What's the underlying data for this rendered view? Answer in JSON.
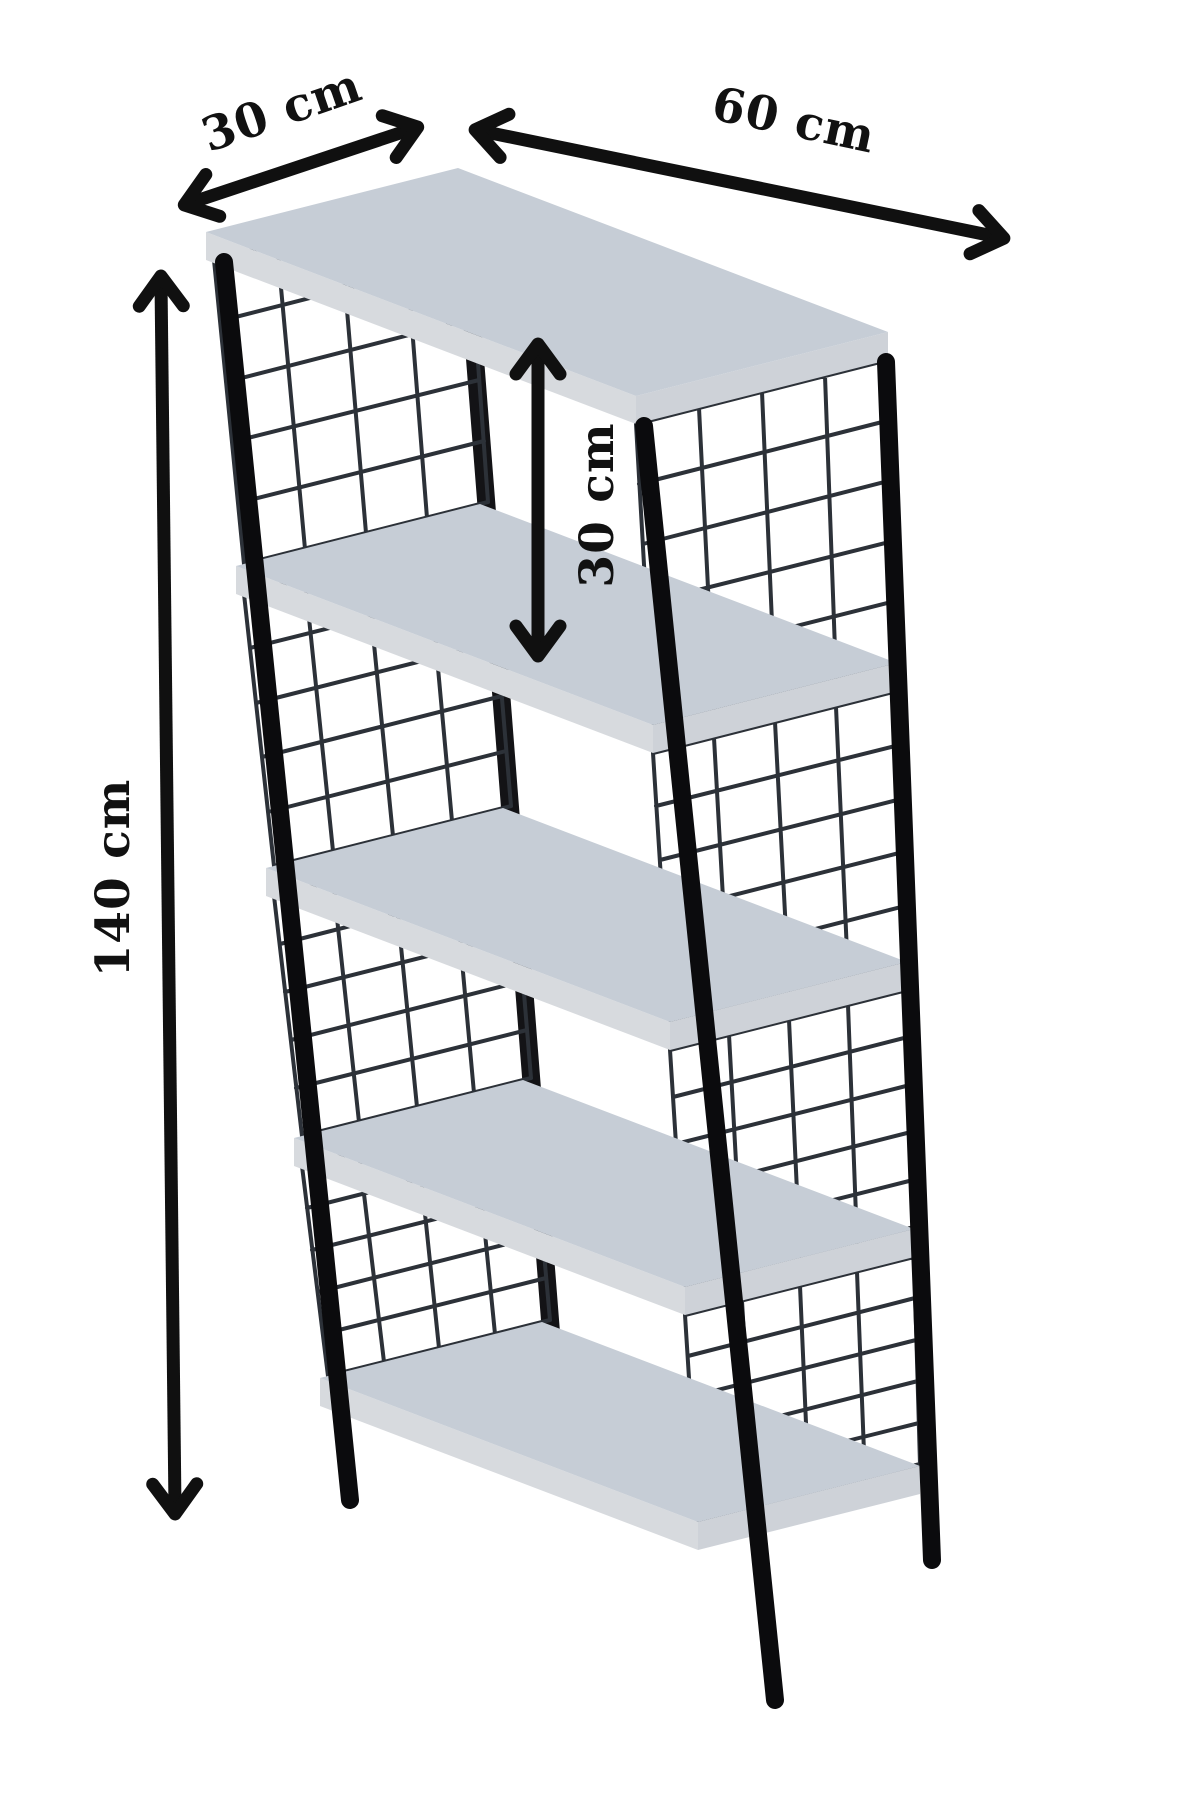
{
  "diagram": {
    "type": "product-dimension-diagram",
    "subject": "5-tier shelving unit with black tube legs and wire mesh side panels",
    "shelf_count": 5,
    "labels": {
      "depth": "30 cm",
      "width": "60 cm",
      "shelf_spacing": "30 cm",
      "height": "140 cm"
    },
    "colors": {
      "background": "#ffffff",
      "shelf_top": "#c6cdd6",
      "shelf_edge_left": "#d7dade",
      "shelf_edge_right": "#ced2d8",
      "leg": "#0b0b0d",
      "mesh_wire": "#2c3138",
      "dimension_ink": "#101010"
    }
  }
}
